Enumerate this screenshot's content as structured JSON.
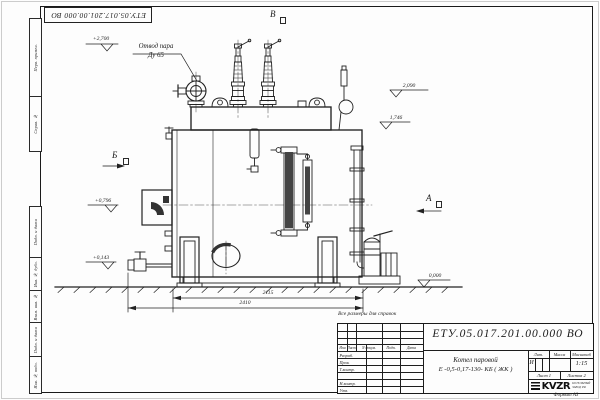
{
  "sheet": {
    "corner_stamp": "ЕТУ.05.017.201.00.000  ВО",
    "note": "Все размеры для справок",
    "format_label": "Формат А3",
    "margin_labels": [
      "Перв. примен.",
      "Справ. №",
      "Подп. и дата",
      "Инв. № дубл.",
      "Взам. инв. №",
      "Подп. и дата",
      "Инв. № подл."
    ]
  },
  "drawing": {
    "callout_line1": "Отвод пара",
    "callout_line2": "Ду 65",
    "view_b": "Б",
    "view_v": "В",
    "view_a": "А",
    "elev_top": "+2,700",
    "elev_2090": "2,090",
    "elev_1746": "1,746",
    "elev_0796": "+0,796",
    "elev_0143": "+0,143",
    "elev_zero": "0,000",
    "dim_inner": "2115",
    "dim_outer": "2410"
  },
  "title_block": {
    "doc_number": "ЕТУ.05.017.201.00.000  ВО",
    "product_line1": "Котел паровой",
    "product_line2": "Е -0,5-0,17-130- КБ ( ЖК )",
    "col_izm": "Изм",
    "col_list": "Лист",
    "col_doc": "N докум.",
    "col_podp": "Подп.",
    "col_data": "Дата",
    "row_razrab": "Разраб.",
    "row_prov": "Пров.",
    "row_tkontr": "Т.контр.",
    "row_nkontr": "Н.контр.",
    "row_utv": "Утв.",
    "lit_label": "Лит.",
    "lit_value": "И",
    "massa_label": "Масса",
    "scale_label": "Масштаб",
    "scale_value": "1:15",
    "sheet_no": "Лист 1",
    "sheets_total": "Листов 2",
    "logo_text": "KVZR",
    "logo_line1": "КОТЕЛЬНЫЙ",
    "logo_line2": "ЗАВОД РФ"
  }
}
